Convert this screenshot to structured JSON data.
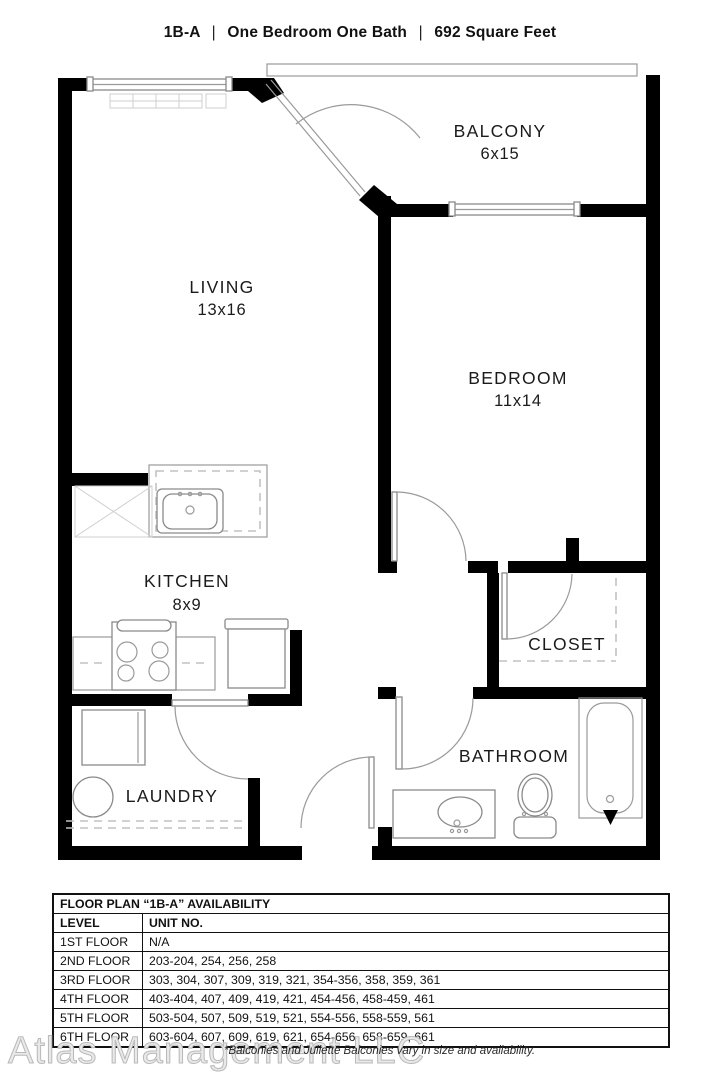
{
  "header": {
    "parts": [
      "1B-A",
      "One Bedroom One Bath",
      "692 Square Feet"
    ],
    "separator": "|"
  },
  "floorplan": {
    "rooms": [
      {
        "name": "BALCONY",
        "dims": "6x15"
      },
      {
        "name": "LIVING",
        "dims": "13x16"
      },
      {
        "name": "BEDROOM",
        "dims": "11x14"
      },
      {
        "name": "KITCHEN",
        "dims": "8x9"
      },
      {
        "name": "CLOSET",
        "dims": ""
      },
      {
        "name": "BATHROOM",
        "dims": ""
      },
      {
        "name": "LAUNDRY",
        "dims": ""
      }
    ]
  },
  "availability": {
    "title": "FLOOR PLAN “1B-A” AVAILABILITY",
    "columns": [
      "LEVEL",
      "UNIT NO."
    ],
    "rows": [
      [
        "1ST FLOOR",
        "N/A"
      ],
      [
        "2ND FLOOR",
        "203-204, 254, 256, 258"
      ],
      [
        "3RD FLOOR",
        "303, 304, 307, 309, 319, 321, 354-356, 358, 359, 361"
      ],
      [
        "4TH FLOOR",
        "403-404, 407, 409, 419, 421, 454-456, 458-459, 461"
      ],
      [
        "5TH FLOOR",
        "503-504, 507, 509, 519, 521, 554-556, 558-559, 561"
      ],
      [
        "6TH FLOOR",
        "603-604, 607, 609, 619, 621, 654-656, 658-659, 661"
      ]
    ]
  },
  "footer": {
    "watermark": "Atlas Management LLC",
    "note": "*Balconies and Juliette Balconies vary in size and availability."
  },
  "colors": {
    "wall": "#000000",
    "line": "#9a9a9a",
    "text": "#1b1b1b"
  }
}
